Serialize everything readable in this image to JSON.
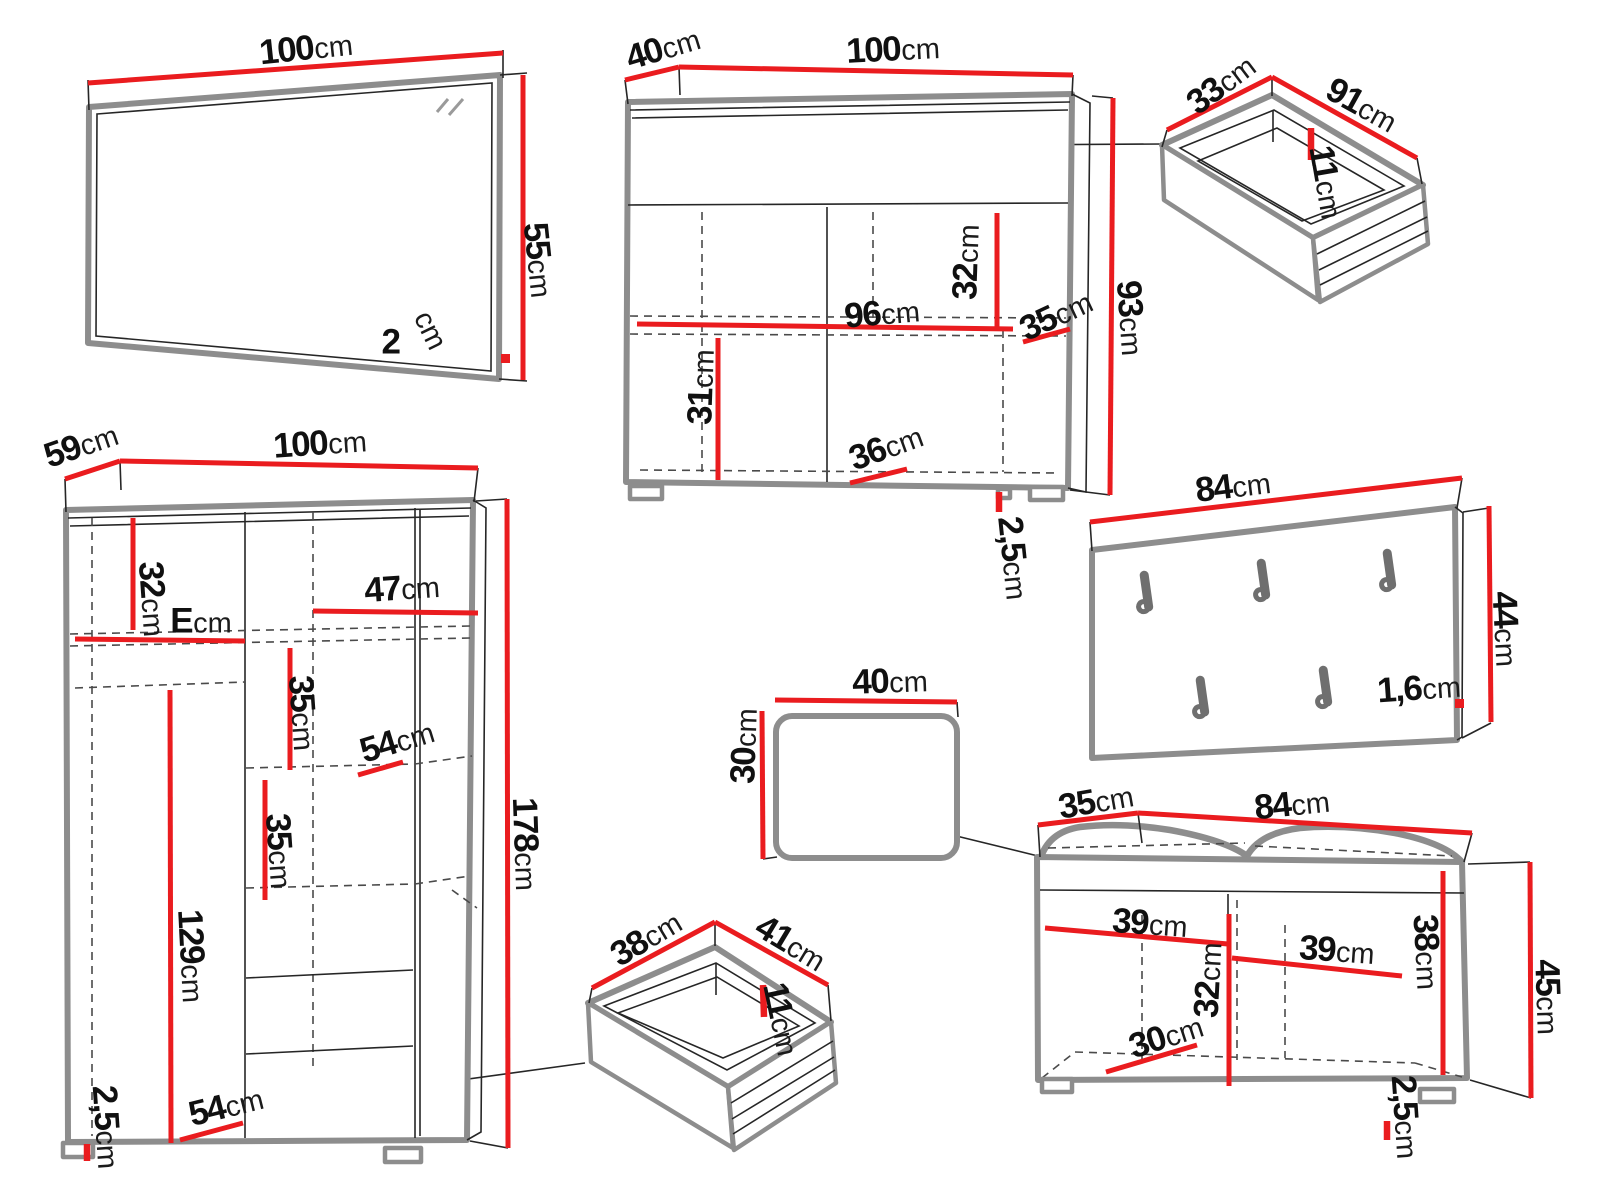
{
  "diagram": {
    "title": "hallway-furniture-set-dimension-diagram",
    "unit": "cm",
    "canvas": {
      "width": 1600,
      "height": 1200
    },
    "colors": {
      "dimension_red": "#ea1c1f",
      "outline_gray": "#8d8d8d",
      "edge_black": "#262626"
    },
    "items": [
      {
        "id": "mirror",
        "labels": [
          {
            "num": "100",
            "unit": "cm",
            "x": 306,
            "y": 48,
            "rot": -6
          },
          {
            "num": "55",
            "unit": "cm",
            "x": 539,
            "y": 260,
            "rot": 84
          },
          {
            "num": "2",
            "unit": "",
            "x": 391,
            "y": 342,
            "rot": 0
          },
          {
            "num": "",
            "unit": "cm",
            "x": 432,
            "y": 329,
            "rot": 64
          }
        ]
      },
      {
        "id": "sideboard",
        "labels": [
          {
            "num": "40",
            "unit": "cm",
            "x": 663,
            "y": 48,
            "rot": -17
          },
          {
            "num": "100",
            "unit": "cm",
            "x": 893,
            "y": 49,
            "rot": -3
          },
          {
            "num": "32",
            "unit": "cm",
            "x": 966,
            "y": 262,
            "rot": -88
          },
          {
            "num": "96",
            "unit": "cm",
            "x": 882,
            "y": 313,
            "rot": -5
          },
          {
            "num": "35",
            "unit": "cm",
            "x": 1056,
            "y": 315,
            "rot": -25
          },
          {
            "num": "93",
            "unit": "cm",
            "x": 1131,
            "y": 318,
            "rot": 86
          },
          {
            "num": "31",
            "unit": "cm",
            "x": 701,
            "y": 387,
            "rot": -88
          },
          {
            "num": "36",
            "unit": "cm",
            "x": 886,
            "y": 447,
            "rot": -20
          },
          {
            "num": "2,5",
            "unit": "cm",
            "x": 1014,
            "y": 558,
            "rot": 84
          }
        ]
      },
      {
        "id": "large-drawer",
        "labels": [
          {
            "num": "33",
            "unit": "cm",
            "x": 1221,
            "y": 84,
            "rot": -37
          },
          {
            "num": "91",
            "unit": "cm",
            "x": 1362,
            "y": 105,
            "rot": 29
          },
          {
            "num": "11",
            "unit": "cm",
            "x": 1327,
            "y": 182,
            "rot": 80
          }
        ]
      },
      {
        "id": "wardrobe",
        "labels": [
          {
            "num": "59",
            "unit": "cm",
            "x": 81,
            "y": 445,
            "rot": -19
          },
          {
            "num": "100",
            "unit": "cm",
            "x": 320,
            "y": 443,
            "rot": -4
          },
          {
            "num": "32",
            "unit": "cm",
            "x": 153,
            "y": 599,
            "rot": 86
          },
          {
            "num": "E",
            "unit": "cm",
            "x": 201,
            "y": 621,
            "rot": 0
          },
          {
            "num": "47",
            "unit": "cm",
            "x": 402,
            "y": 588,
            "rot": -4
          },
          {
            "num": "35",
            "unit": "cm",
            "x": 303,
            "y": 713,
            "rot": 86
          },
          {
            "num": "54",
            "unit": "cm",
            "x": 397,
            "y": 741,
            "rot": -17
          },
          {
            "num": "35",
            "unit": "cm",
            "x": 280,
            "y": 851,
            "rot": 86
          },
          {
            "num": "129",
            "unit": "cm",
            "x": 192,
            "y": 956,
            "rot": 87
          },
          {
            "num": "178",
            "unit": "cm",
            "x": 526,
            "y": 844,
            "rot": 88
          },
          {
            "num": "2,5",
            "unit": "cm",
            "x": 107,
            "y": 1127,
            "rot": 86
          },
          {
            "num": "54",
            "unit": "cm",
            "x": 226,
            "y": 1106,
            "rot": -14
          }
        ]
      },
      {
        "id": "coat-rack",
        "labels": [
          {
            "num": "84",
            "unit": "cm",
            "x": 1233,
            "y": 486,
            "rot": -7
          },
          {
            "num": "44",
            "unit": "cm",
            "x": 1506,
            "y": 629,
            "rot": 87
          },
          {
            "num": "1,6",
            "unit": "cm",
            "x": 1419,
            "y": 688,
            "rot": -4
          }
        ]
      },
      {
        "id": "seat-cushion",
        "labels": [
          {
            "num": "40",
            "unit": "cm",
            "x": 890,
            "y": 681,
            "rot": -2
          },
          {
            "num": "30",
            "unit": "cm",
            "x": 744,
            "y": 746,
            "rot": -88
          }
        ]
      },
      {
        "id": "small-drawer",
        "labels": [
          {
            "num": "38",
            "unit": "cm",
            "x": 646,
            "y": 938,
            "rot": -31
          },
          {
            "num": "41",
            "unit": "cm",
            "x": 791,
            "y": 943,
            "rot": 31
          },
          {
            "num": "11",
            "unit": "cm",
            "x": 782,
            "y": 1019,
            "rot": 78
          }
        ]
      },
      {
        "id": "shoe-bench",
        "labels": [
          {
            "num": "35",
            "unit": "cm",
            "x": 1096,
            "y": 801,
            "rot": -10
          },
          {
            "num": "84",
            "unit": "cm",
            "x": 1292,
            "y": 804,
            "rot": -6
          },
          {
            "num": "39",
            "unit": "cm",
            "x": 1150,
            "y": 923,
            "rot": 4
          },
          {
            "num": "39",
            "unit": "cm",
            "x": 1337,
            "y": 950,
            "rot": 4
          },
          {
            "num": "32",
            "unit": "cm",
            "x": 1208,
            "y": 980,
            "rot": -87
          },
          {
            "num": "38",
            "unit": "cm",
            "x": 1427,
            "y": 952,
            "rot": 87
          },
          {
            "num": "30",
            "unit": "cm",
            "x": 1166,
            "y": 1036,
            "rot": -18
          },
          {
            "num": "45",
            "unit": "cm",
            "x": 1548,
            "y": 997,
            "rot": 88
          },
          {
            "num": "2,5",
            "unit": "cm",
            "x": 1406,
            "y": 1117,
            "rot": 86
          }
        ]
      }
    ]
  }
}
